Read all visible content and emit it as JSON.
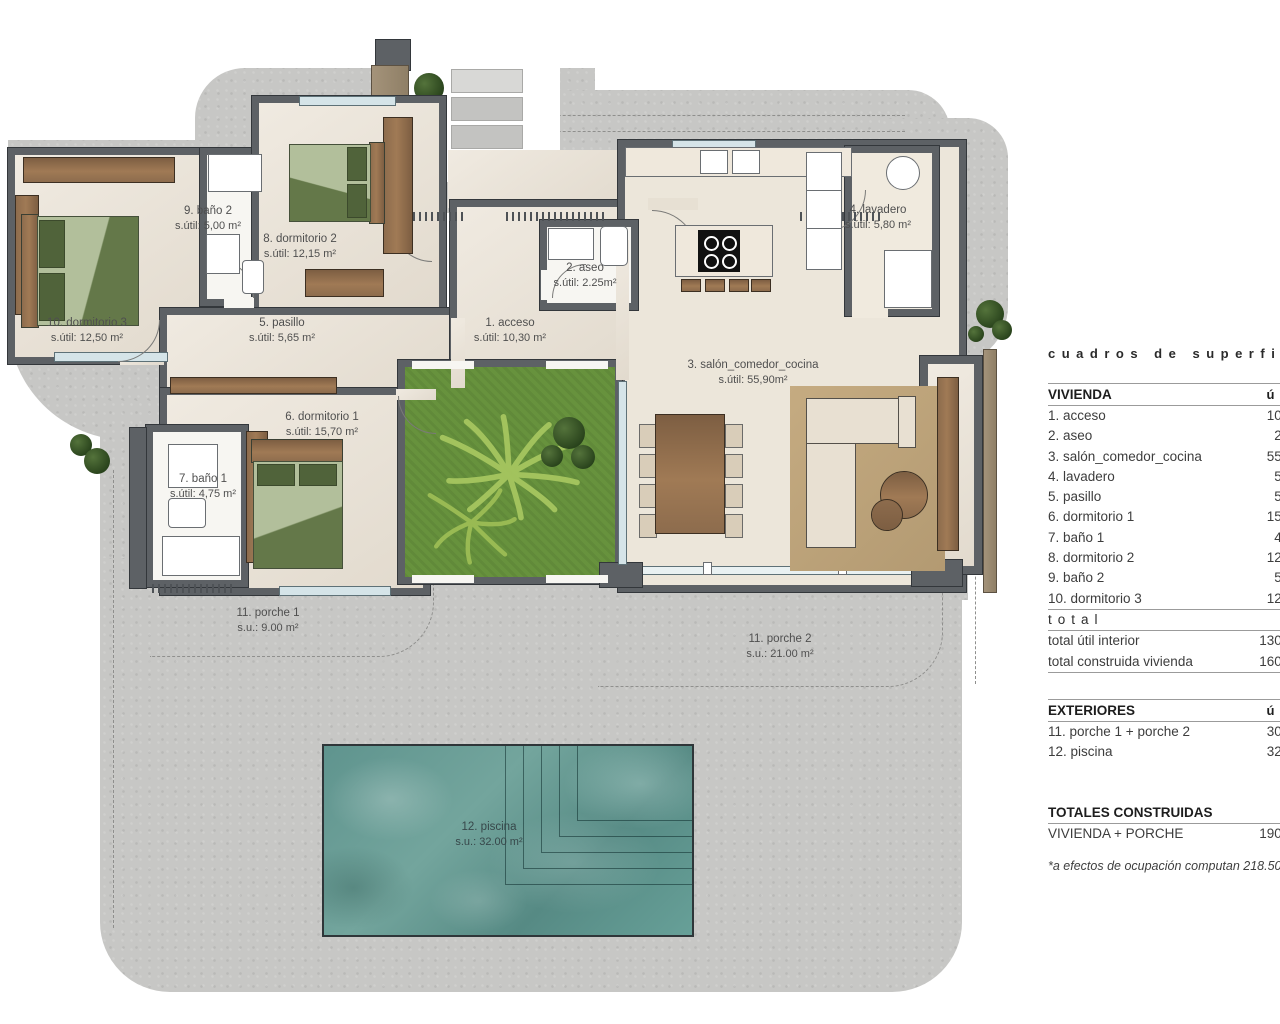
{
  "plan": {
    "labels": [
      {
        "name": "1. acceso",
        "area": "s.útil: 10,30 m²"
      },
      {
        "name": "2. aseo",
        "area": "s.útil: 2.25m²"
      },
      {
        "name": "3. salón_comedor_cocina",
        "area": "s.útil: 55,90m²"
      },
      {
        "name": "4. lavadero",
        "area": "s.útil: 5,80 m²"
      },
      {
        "name": "5. pasillo",
        "area": "s.útil: 5,65 m²"
      },
      {
        "name": "6. dormitorio 1",
        "area": "s.útil: 15,70 m²"
      },
      {
        "name": "7. baño 1",
        "area": "s.útil: 4,75 m²"
      },
      {
        "name": "8. dormitorio 2",
        "area": "s.útil: 12,15 m²"
      },
      {
        "name": "9. baño 2",
        "area": "s.útil: 5,00 m²"
      },
      {
        "name": "10. dormitorio 3",
        "area": "s.útil: 12,50 m²"
      },
      {
        "name": "11. porche 1",
        "area": "s.u.: 9.00 m²"
      },
      {
        "name": "11. porche 2",
        "area": "s.u.: 21.00 m²"
      },
      {
        "name": "12. piscina",
        "area": "s.u.: 32.00 m²"
      }
    ]
  },
  "table": {
    "title": "cuadros de superficie",
    "vivienda": {
      "header": "VIVIENDA",
      "unit_col": "útil",
      "rows": [
        {
          "label": "1. acceso",
          "value": "10,30 m²"
        },
        {
          "label": "2. aseo",
          "value": "2,25 m²"
        },
        {
          "label": "3. salón_comedor_cocina",
          "value": "55,90 m²"
        },
        {
          "label": "4. lavadero",
          "value": "5,80 m²"
        },
        {
          "label": "5. pasillo",
          "value": "5,65 m²"
        },
        {
          "label": "6. dormitorio 1",
          "value": "15,70 m²"
        },
        {
          "label": "7. baño 1",
          "value": "4,75 m²"
        },
        {
          "label": "8. dormitorio 2",
          "value": "12,15 m²"
        },
        {
          "label": "9. baño 2",
          "value": "5,00 m²"
        },
        {
          "label": "10. dormitorio 3",
          "value": "12,50 m²"
        }
      ]
    },
    "total_label": "total",
    "totals": [
      {
        "label": "total útil interior",
        "value": "130.00 m²"
      },
      {
        "label": "total construida vivienda",
        "value": "160.00 m²"
      }
    ],
    "exteriores": {
      "header": "EXTERIORES",
      "unit_col": "útil",
      "rows": [
        {
          "label": "11. porche 1 + porche 2",
          "value": "30.00 m²"
        },
        {
          "label": "12. piscina",
          "value": "32.00 m²"
        }
      ]
    },
    "totales_construidas": {
      "header": "TOTALES CONSTRUIDAS",
      "rows": [
        {
          "label": "VIVIENDA + PORCHE",
          "value": "190.00 m²"
        }
      ]
    },
    "note": "*a efectos de ocupación computan 218.50 m²"
  },
  "colors": {
    "terrace": "#c7c7c5",
    "interior_floor": "#eae2d5",
    "walls": "#5d6165",
    "garden": "#67923d",
    "pool": "#5f948e",
    "wood": "#8d6c4d",
    "text": "#4a4a4a"
  }
}
